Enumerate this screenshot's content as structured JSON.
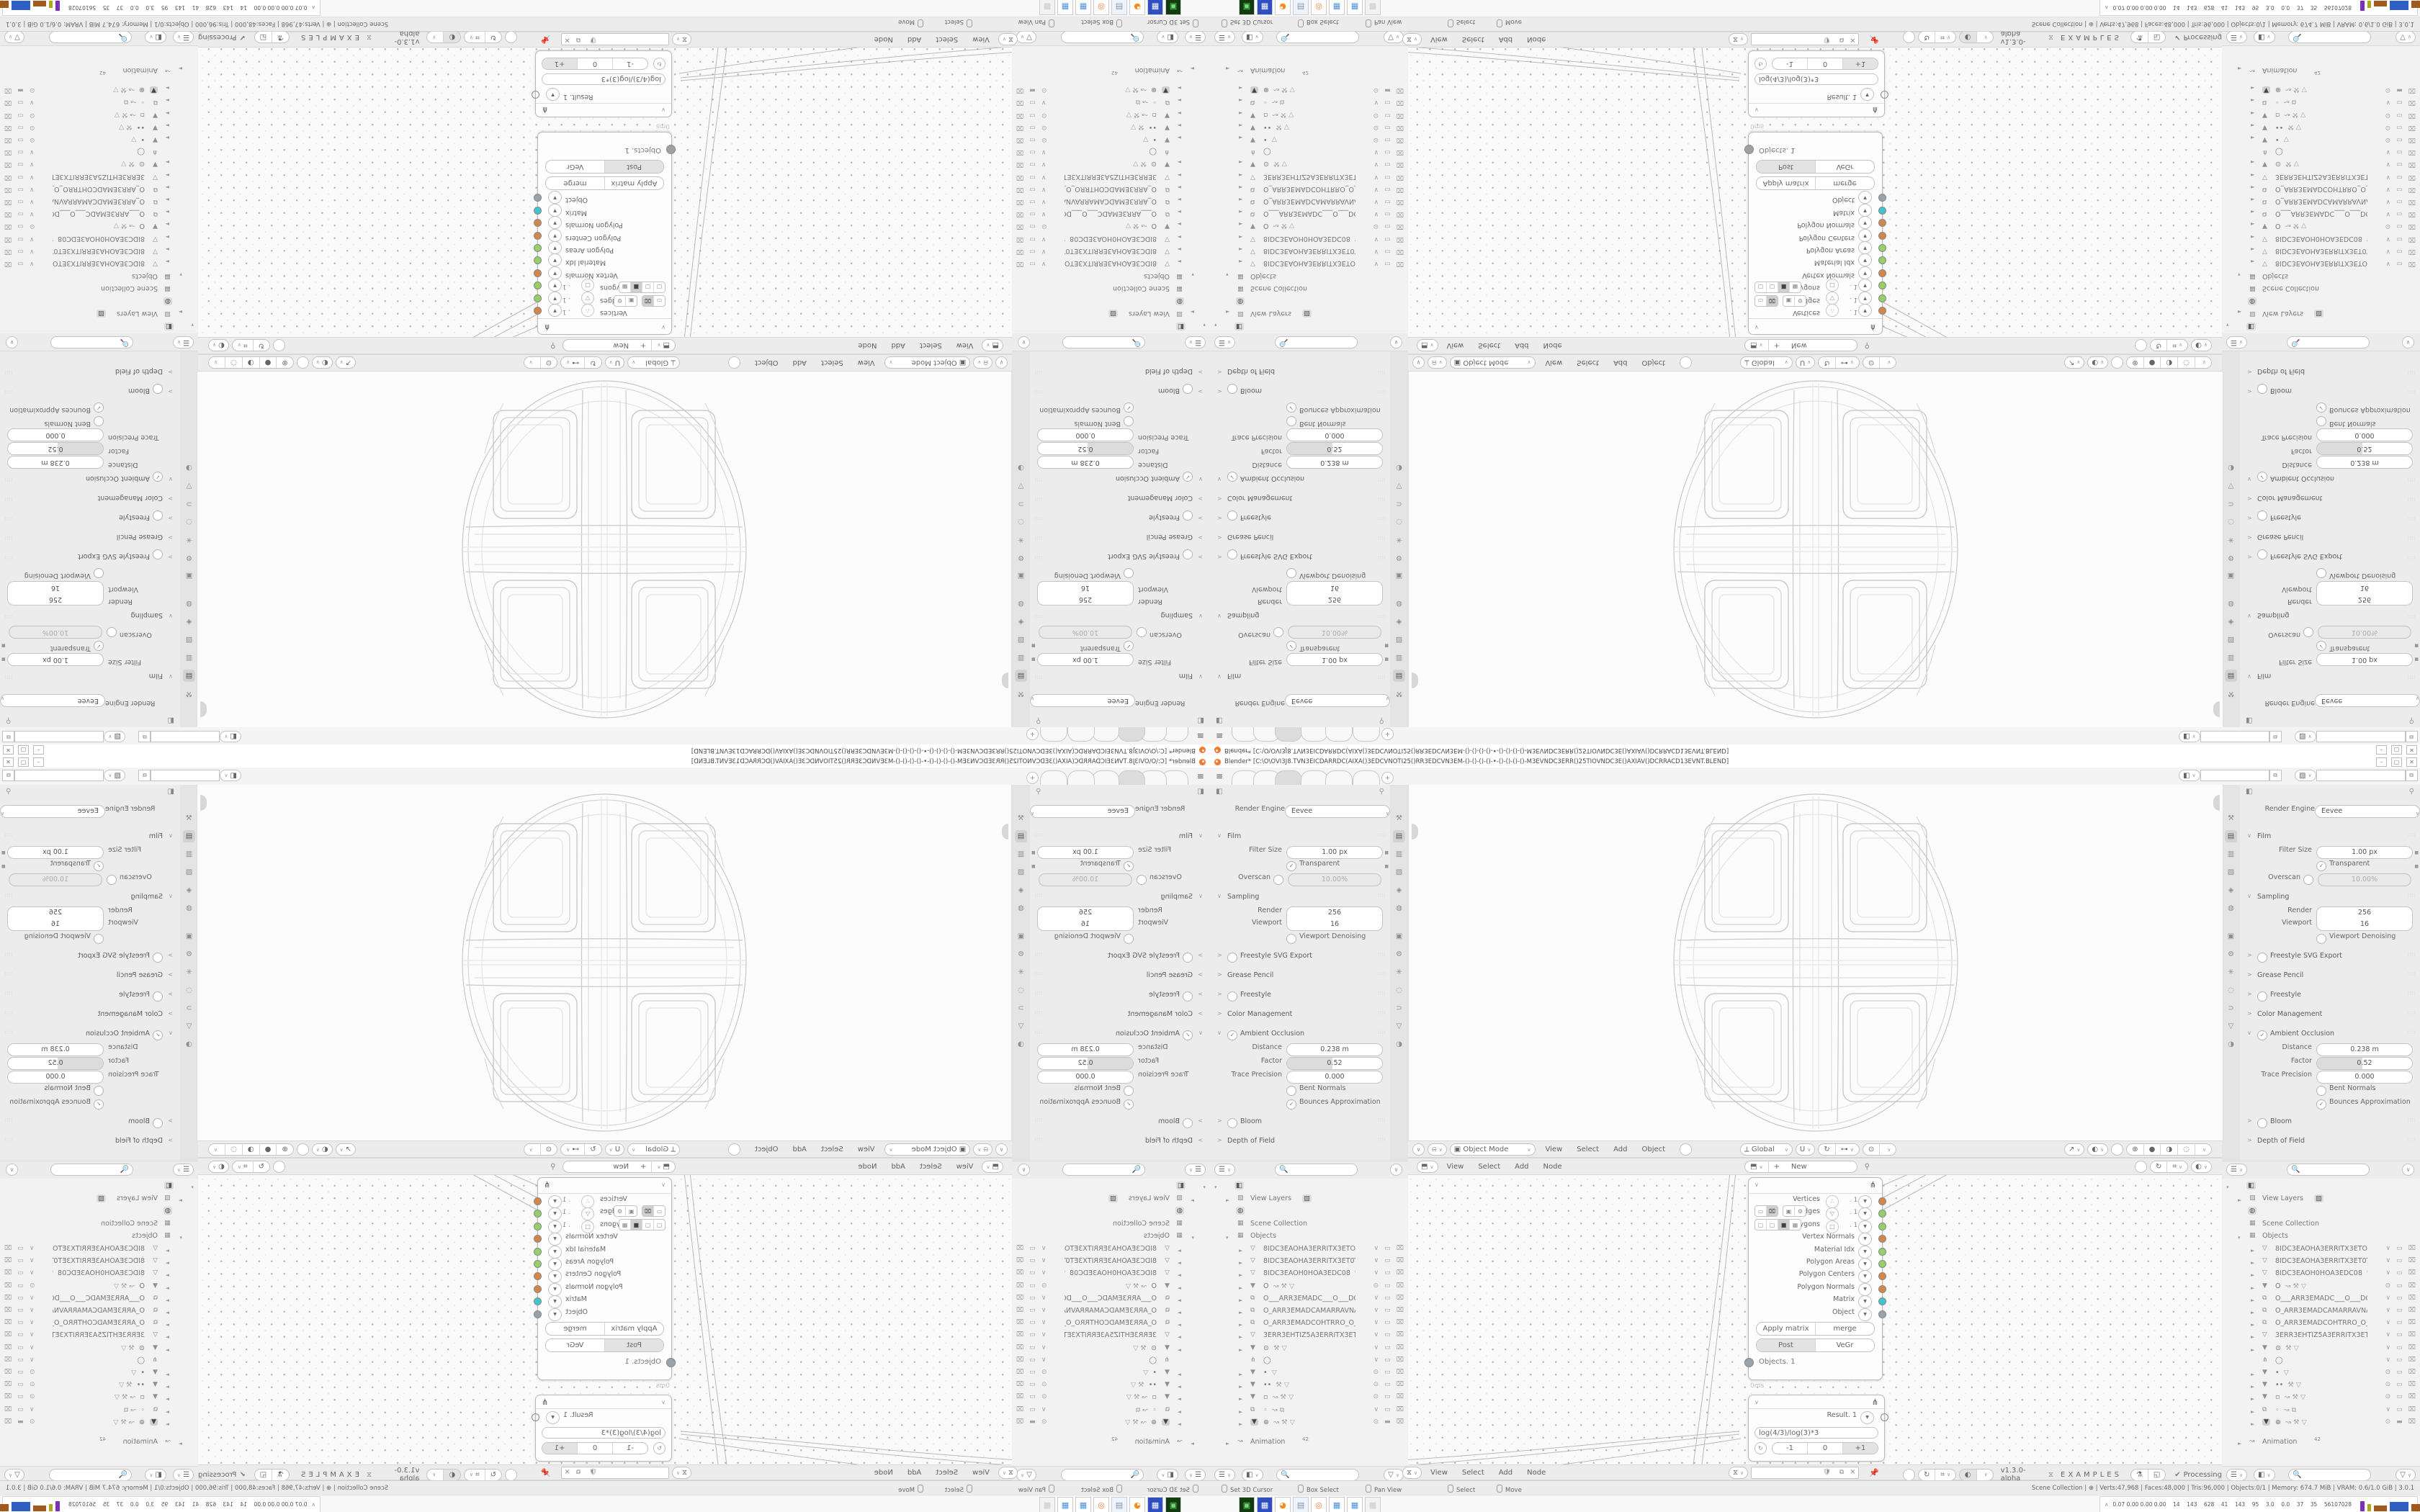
{
  "window": {
    "title": "Blender* [C:\\O\\OVI3J8.TVN3EICDARRDC(AIXA()3EDCVNOTI25()RR3EDCVN3EM-()-()-()-()-•-()-()-()-()-M3EVNDC3ERR()25TIOVNDC3E()AXIAV()DCRRACD13EVNT.BLEND]",
    "minimize": "–",
    "maximize": "▢",
    "close": "✕",
    "add_tab": "+"
  },
  "props": {
    "engine_label": "Render Engine",
    "engine_value": "Eevee",
    "tabs": [
      "⚒",
      "▤",
      "▥",
      "▧",
      "◈",
      "◍",
      "▣",
      "⚙",
      "✳",
      "◌",
      "⊃",
      "▽",
      "◑"
    ],
    "active_tab_index": 1,
    "rows": [
      {
        "k": "section",
        "label": "Film",
        "open": true
      },
      {
        "k": "field",
        "label": "Filter Size",
        "value": "1.00 px",
        "dot": true
      },
      {
        "k": "check",
        "label": "Transparent",
        "checked": true,
        "dot": true
      },
      {
        "k": "checkfield",
        "label": "Overscan",
        "value": "10.00%",
        "checked": false
      },
      {
        "k": "section",
        "label": "Sampling",
        "open": true
      },
      {
        "k": "dual1",
        "label": "Render",
        "value": "256"
      },
      {
        "k": "dual2",
        "label": "Viewport",
        "value": "16"
      },
      {
        "k": "check",
        "label": "Viewport Denoising",
        "checked": false
      },
      {
        "k": "section",
        "label": "Freestyle SVG Export",
        "open": false,
        "check": false
      },
      {
        "k": "section",
        "label": "Grease Pencil",
        "open": false
      },
      {
        "k": "section",
        "label": "Freestyle",
        "open": false,
        "check": false
      },
      {
        "k": "section",
        "label": "Color Management",
        "open": false
      },
      {
        "k": "section",
        "label": "Ambient Occlusion",
        "open": true,
        "check": true
      },
      {
        "k": "field",
        "label": "Distance",
        "value": "0.238 m"
      },
      {
        "k": "slider",
        "label": "Factor",
        "value": "0.52"
      },
      {
        "k": "field",
        "label": "Trace Precision",
        "value": "0.000"
      },
      {
        "k": "check",
        "label": "Bent Normals",
        "checked": false
      },
      {
        "k": "check",
        "label": "Bounces Approximation",
        "checked": true
      },
      {
        "k": "section",
        "label": "Bloom",
        "open": false,
        "check": false
      },
      {
        "k": "section",
        "label": "Depth of Field",
        "open": false
      }
    ]
  },
  "outliner": {
    "view_layers": "View Layers",
    "scene_collection": "Scene Collection",
    "objects": "Objects",
    "animation": "Animation",
    "anim_badge": "42",
    "rows": [
      {
        "ic": "▽",
        "n": "8IDC3EAOHA3ERRITX3ETOT3EXTIS",
        "ex": "",
        "r": "v"
      },
      {
        "ic": "▽",
        "n": "8IDC3EAOHA3ERRITX3ET0T3EXTIS",
        "ex": "",
        "r": "v"
      },
      {
        "ic": "▽",
        "n": "8IDC3EAOH0HOA3EDC08",
        "ex": "▽",
        "r": "v"
      },
      {
        "ic": "▼",
        "n": "O",
        "ex": "↝ ⚒ ▽",
        "r": "e"
      },
      {
        "ic": "⧉",
        "n": "O___ARR3EMADC___O___DCAM3I",
        "ex": "",
        "r": "v"
      },
      {
        "ic": "⧉",
        "n": "O_ARR3EMADCAMARRAVNATI_O",
        "ex": "",
        "r": "v"
      },
      {
        "ic": "⧉",
        "n": "O_ARR3EMADCOHTRRO_O_ORRTH",
        "ex": "",
        "r": "v"
      },
      {
        "ic": "▽",
        "n": "3ERR3EHTIZ5A3ERRITX3ETOT3EXTI",
        "ex": "",
        "r": "v"
      },
      {
        "ic": "▼",
        "n": "⊙",
        "ex": "⚒ ▽",
        "r": "v"
      },
      {
        "ic": "⋔",
        "n": "◯",
        "ex": "",
        "r": "v",
        "na": 1
      },
      {
        "ic": "▼",
        "n": "•",
        "ex": "▽",
        "r": "e"
      },
      {
        "ic": "▼",
        "n": "••",
        "ex": "⚒ ▽",
        "r": "e"
      },
      {
        "ic": "▼",
        "n": "▫",
        "ex": "↝ ⚒ ▽",
        "r": "e"
      },
      {
        "ic": "⧉",
        "n": "◦",
        "ex": "↝ ⧉",
        "r": "v"
      },
      {
        "ic": "▼",
        "n": "⊕",
        "ex": "↝ ⚒ ▽",
        "r": "e",
        "sel": 1
      }
    ]
  },
  "viewport": {
    "mode": "Object Mode",
    "menus": [
      "View",
      "Select",
      "Add",
      "Object"
    ],
    "orientation": "Global"
  },
  "node_editor": {
    "menus": [
      "View",
      "Select",
      "Add",
      "Node"
    ],
    "new_button": "New",
    "version": "v1.3.0-alpha",
    "brand": "EXAMPLES",
    "processing": "Processing",
    "node1": {
      "outputs": [
        {
          "label": "Vertices",
          "icon": "∴",
          "suffix": ". 1",
          "color": "#d4854a"
        },
        {
          "label": "Edges",
          "icon": "▽",
          "suffix": ". 1",
          "color": "#96ce67"
        },
        {
          "label": "Polygons",
          "icon": "□",
          "suffix": ". 1",
          "color": "#96ce67"
        },
        {
          "label": "Vertex Normals",
          "icon": "",
          "suffix": "",
          "color": "#d4854a"
        },
        {
          "label": "Material Idx",
          "icon": "",
          "suffix": "",
          "color": "#96ce67"
        },
        {
          "label": "Polygon Areas",
          "icon": "",
          "suffix": "",
          "color": "#96ce67"
        },
        {
          "label": "Polygon Centers",
          "icon": "",
          "suffix": "",
          "color": "#d4854a"
        },
        {
          "label": "Polygon Normals",
          "icon": "",
          "suffix": "",
          "color": "#d4854a"
        },
        {
          "label": "Matrix",
          "icon": "",
          "suffix": "",
          "color": "#41c5cc"
        },
        {
          "label": "Object",
          "icon": "",
          "suffix": "",
          "color": "#9aa3a9"
        }
      ],
      "btn_apply": "Apply matrix",
      "btn_merge": "merge",
      "btn_post": "Post",
      "btn_vegr": "VeGr",
      "footer_socket": "Objects. 1",
      "timing": "0ms"
    },
    "node2": {
      "result": "Result. 1",
      "formula": "log(4/3)/log(3)*3",
      "b1": "-1",
      "b2": "0",
      "b3": "+1",
      "color": "#96ce67"
    }
  },
  "status": {
    "left": [
      "Set 3D Cursor",
      "Box Select",
      "Pan View",
      "Select",
      "Move"
    ],
    "right": "Scene Collection  |  ⊕  |  Verts:47,968  |  Faces:48,000  |  Tris:96,000  |  Objects:0/1  |  Memory: 674.7 MiB  |  VRAM: 0.6/1.0 GiB  |  3.0.1"
  },
  "taskbar": {
    "tray_text": "0.07 0.00 0.00 0.00    14    143    628    41    143    95    3.0    0.0    37    35    56107028",
    "apps": [
      {
        "c": "#123b12",
        "g": "▣",
        "fg": "#6fe06f"
      },
      {
        "c": "#2f4fc0",
        "g": "▦",
        "fg": "#ffffff"
      },
      {
        "c": "#ffffff",
        "g": "◕",
        "fg": "#ff8a1e"
      },
      {
        "c": "#eef4fb",
        "g": "▤",
        "fg": "#7d94ad"
      },
      {
        "c": "#ffffff",
        "g": "◎",
        "fg": "#f5792a"
      },
      {
        "c": "#ffffff",
        "g": "▦",
        "fg": "#4a90d9"
      },
      {
        "c": "#ffffff",
        "g": "▦",
        "fg": "#4a90d9"
      },
      {
        "c": "#f3f3f3",
        "g": "▩",
        "fg": "#cccccc"
      }
    ],
    "charts": [
      {
        "c": "#7b2fbe",
        "w": 6,
        "h": 14
      },
      {
        "c": "#b0a818",
        "w": 5,
        "h": 10
      },
      {
        "c": "#a05a1e",
        "w": 18,
        "h": 8
      },
      {
        "c": "#2f5fc0",
        "w": 26,
        "h": 13
      },
      {
        "c": "#a05a1e",
        "w": 20,
        "h": 10
      },
      {
        "c": "#3aa83a",
        "w": 16,
        "h": 3
      },
      {
        "c": "#c03a3a",
        "w": 12,
        "h": 6
      }
    ]
  }
}
